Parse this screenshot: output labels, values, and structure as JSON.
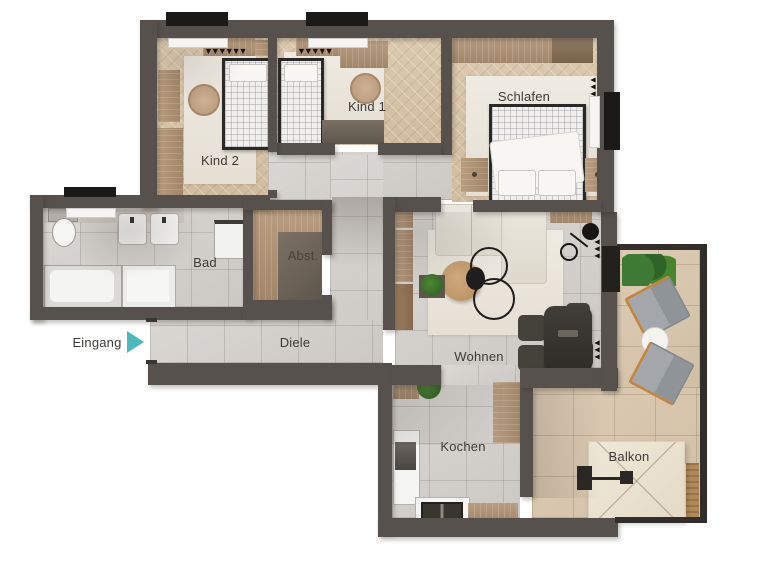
{
  "rooms": {
    "kind2": {
      "label": "Kind 2"
    },
    "kind1": {
      "label": "Kind 1"
    },
    "schlafen": {
      "label": "Schlafen"
    },
    "bad": {
      "label": "Bad"
    },
    "abst": {
      "label": "Abst."
    },
    "diele": {
      "label": "Diele"
    },
    "wohnen": {
      "label": "Wohnen"
    },
    "kochen": {
      "label": "Kochen"
    },
    "balkon": {
      "label": "Balkon"
    }
  },
  "entrance": {
    "label": "Eingang",
    "arrow_color": "#4cb8ba"
  },
  "colors": {
    "wall": "#57514d",
    "bedroom_wood_floor": "#d6c2a7",
    "tile_floor": "#d3d0cd",
    "balcony_tile_floor": "#d7c7af",
    "furniture_wood": "#b1967a",
    "dark_furniture": "#3a3632",
    "accent_arrow": "#4cb8ba"
  },
  "symbols": {
    "wardrobe_teeth": "▼▼▼▼▼▼",
    "radiator_teeth": "▼▼▼"
  }
}
